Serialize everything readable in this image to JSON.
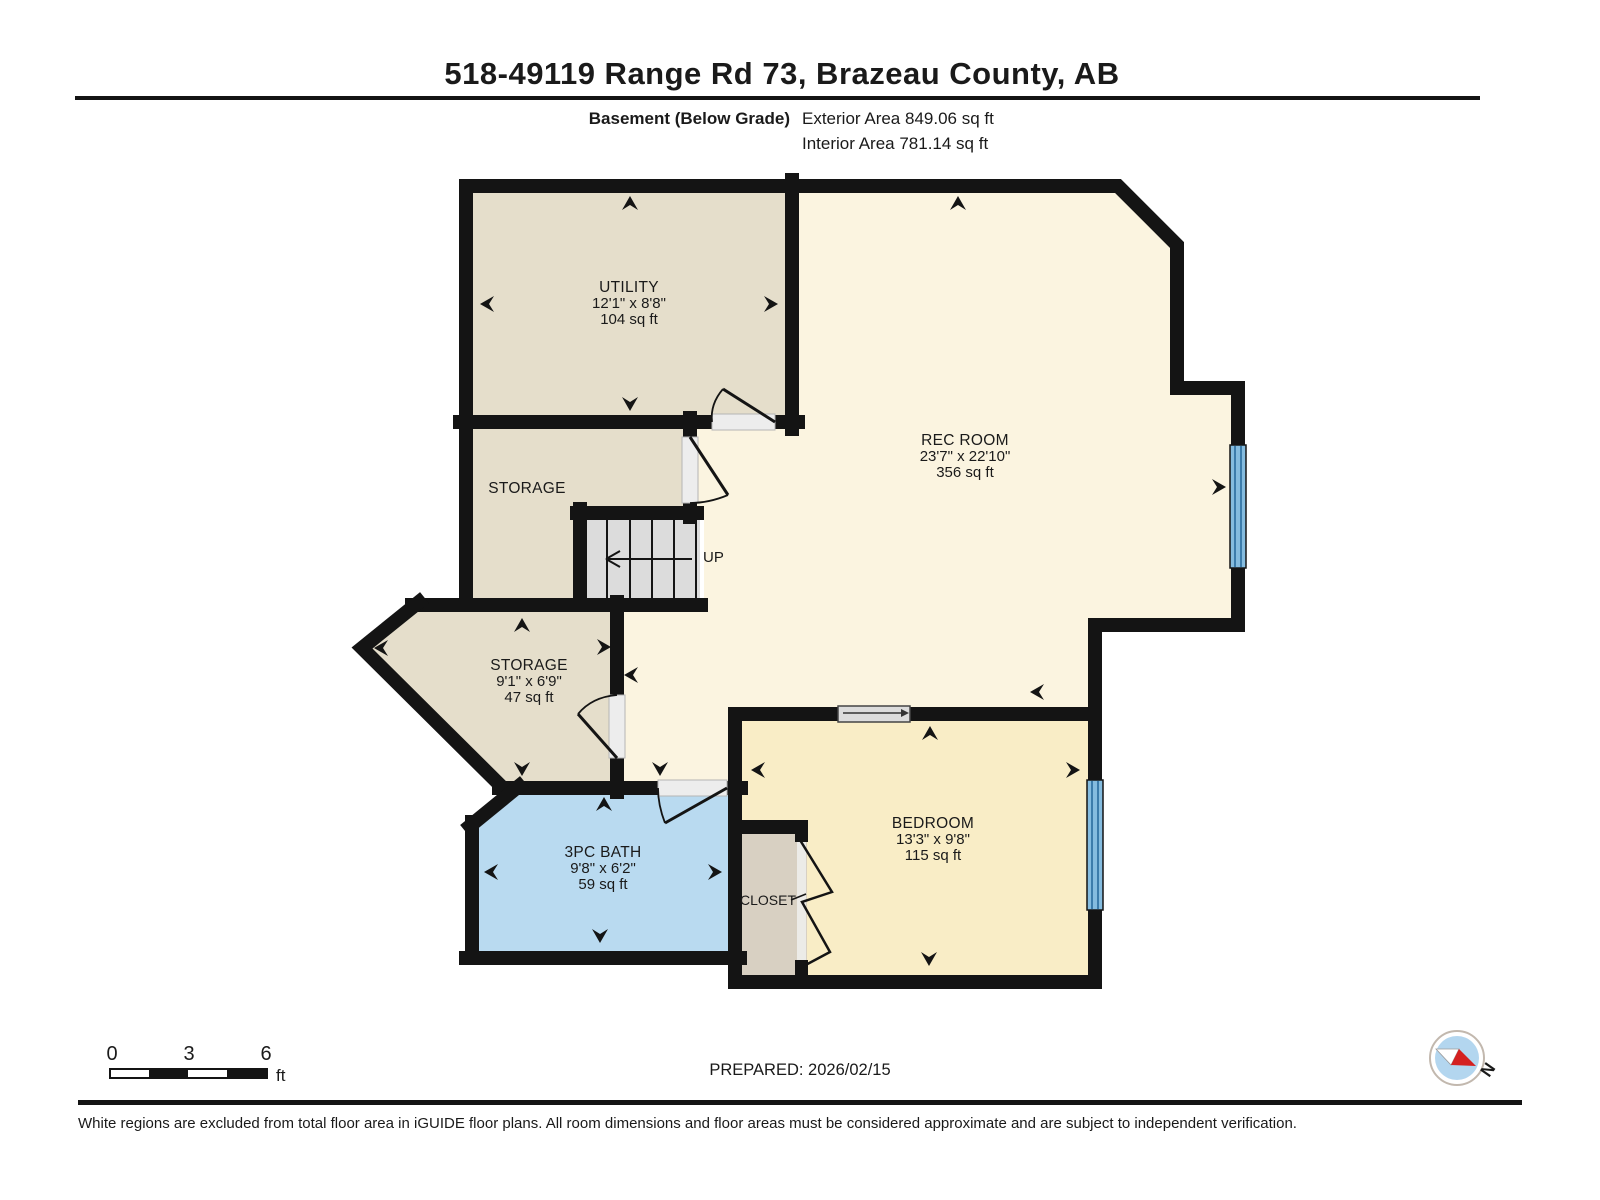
{
  "header": {
    "title": "518-49119 Range Rd 73, Brazeau County, AB",
    "floor_label": "Basement (Below Grade)",
    "exterior_area": "Exterior Area 849.06 sq ft",
    "interior_area": "Interior Area 781.14 sq ft"
  },
  "rooms": {
    "utility": {
      "name": "UTILITY",
      "dims": "12'1\" x 8'8\"",
      "area": "104 sq ft"
    },
    "storage_upper": {
      "name": "STORAGE"
    },
    "rec_room": {
      "name": "REC ROOM",
      "dims": "23'7\" x 22'10\"",
      "area": "356 sq ft"
    },
    "storage_lower": {
      "name": "STORAGE",
      "dims": "9'1\" x 6'9\"",
      "area": "47 sq ft"
    },
    "bath": {
      "name": "3PC BATH",
      "dims": "9'8\" x 6'2\"",
      "area": "59 sq ft"
    },
    "bedroom": {
      "name": "BEDROOM",
      "dims": "13'3\" x 9'8\"",
      "area": "115 sq ft"
    },
    "closet": {
      "name": "CLOSET"
    },
    "stairs": {
      "label": "UP"
    }
  },
  "footer": {
    "prepared": "PREPARED: 2026/02/15",
    "disclaimer": "White regions are excluded from total floor area in iGUIDE floor plans. All room dimensions and floor areas must be considered approximate and are subject to independent verification.",
    "scale": {
      "t0": "0",
      "t1": "3",
      "t2": "6",
      "unit": "ft"
    },
    "compass_label": "N"
  },
  "colors": {
    "wall": "#141414",
    "room_tan": "#e5decb",
    "room_cream": "#fbf4e0",
    "room_cream_dark": "#f9edc6",
    "bath_blue": "#b9daf0",
    "closet_gray": "#d8d0c2",
    "window_blue": "#85bcdf",
    "stair_gray": "#dcdcdc",
    "compass_blue": "#b3d6ef",
    "compass_red": "#d42020"
  }
}
